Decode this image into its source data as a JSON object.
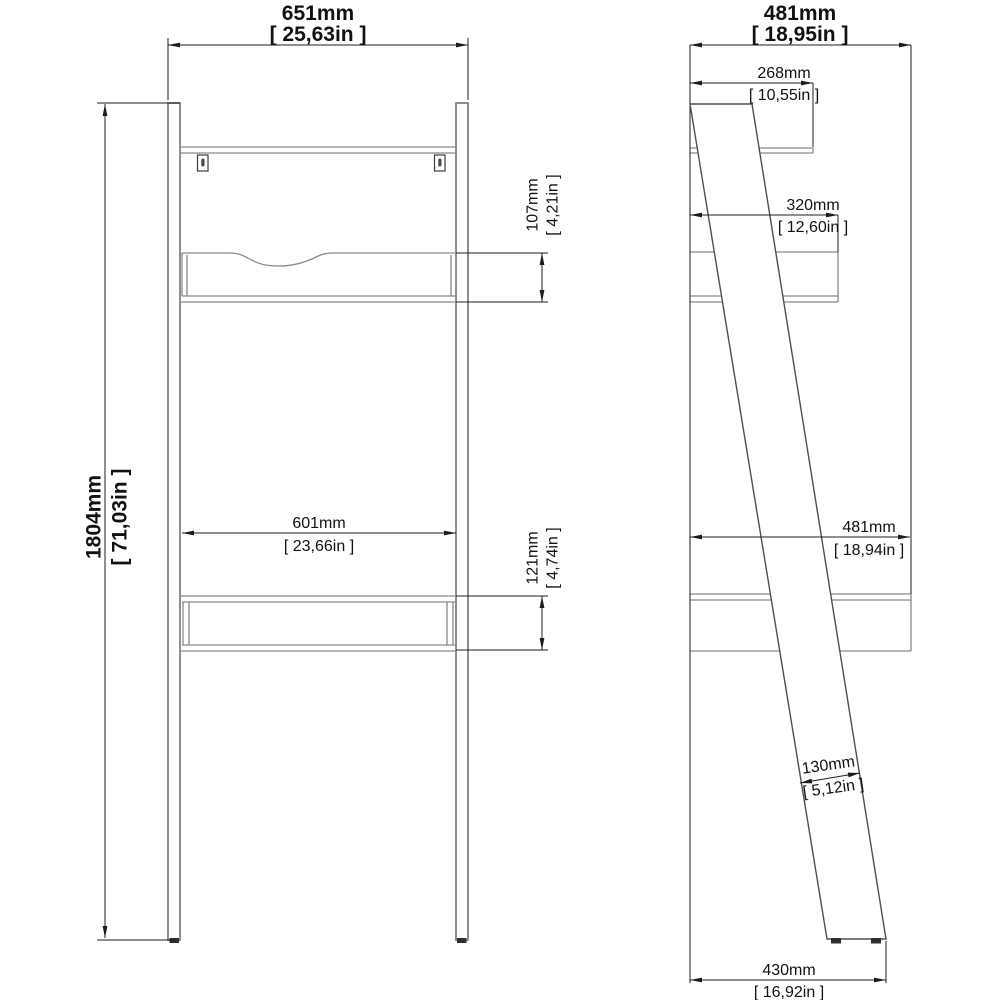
{
  "drawing": {
    "background": "#ffffff",
    "structure_line_color": "#7b7b7b",
    "dimension_line_color": "#1c1c1c"
  },
  "front_view": {
    "overall_width": {
      "mm": "651mm",
      "inch": "[ 25,63in ]"
    },
    "overall_height": {
      "mm": "1804mm",
      "inch": "[ 71,03in ]"
    },
    "drawer_height": {
      "mm": "107mm",
      "inch": "[ 4,21in ]"
    },
    "inner_width": {
      "mm": "601mm",
      "inch": "[ 23,66in ]"
    },
    "desk_height": {
      "mm": "121mm",
      "inch": "[ 4,74in ]"
    }
  },
  "side_view": {
    "overall_depth": {
      "mm": "481mm",
      "inch": "[ 18,95in ]"
    },
    "top_shelf_depth": {
      "mm": "268mm",
      "inch": "[ 10,55in ]"
    },
    "drawer_depth": {
      "mm": "320mm",
      "inch": "[ 12,60in ]"
    },
    "desktop_depth": {
      "mm": "481mm",
      "inch": "[ 18,94in ]"
    },
    "leg_width": {
      "mm": "130mm",
      "inch": "[ 5,12in ]"
    },
    "floor_depth": {
      "mm": "430mm",
      "inch": "[ 16,92in ]"
    }
  }
}
